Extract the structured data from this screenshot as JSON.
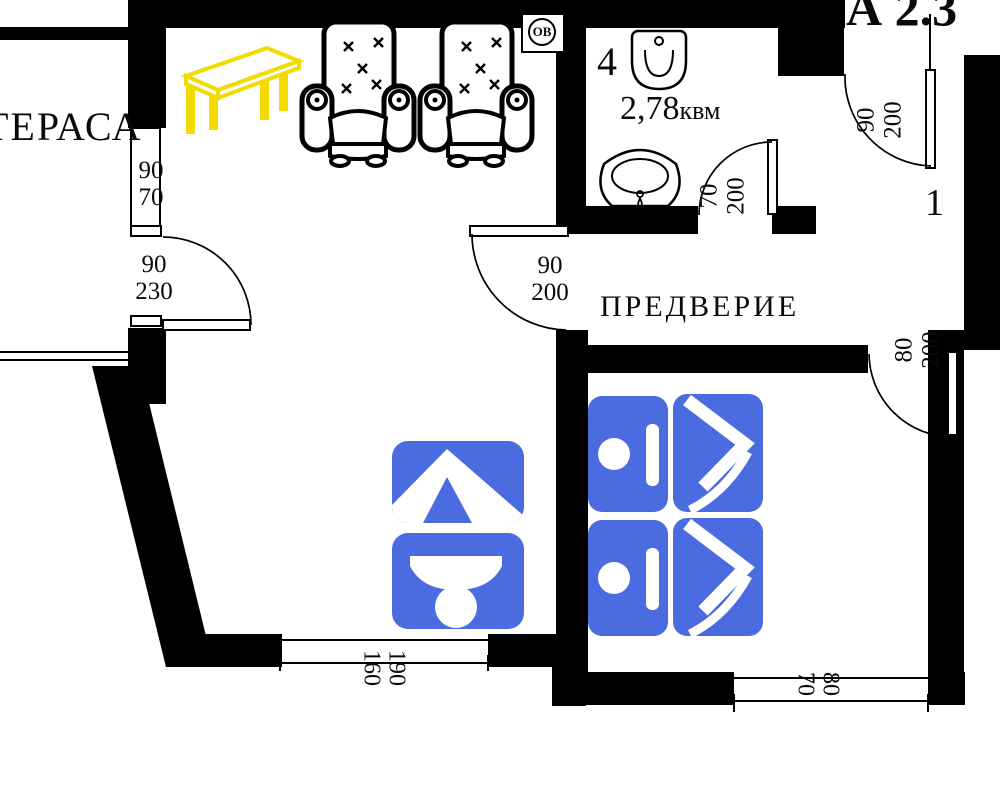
{
  "title": "А 2.3",
  "rooms": {
    "terrace": {
      "label": "ТЕРАСА"
    },
    "vestibule": {
      "label": "ПРЕДВЕРИЕ"
    },
    "bathroom": {
      "number": "4",
      "area_value": "2,78",
      "area_unit": "квм"
    },
    "entry": {
      "number": "1"
    }
  },
  "symbols": {
    "shaft_label": "ОВ"
  },
  "dimensions": {
    "terrace_window": {
      "width": "90",
      "height": "70"
    },
    "terrace_door": {
      "width": "90",
      "height": "230"
    },
    "living_vestibule_door": {
      "width": "90",
      "height": "200"
    },
    "bathroom_door": {
      "width": "70",
      "height": "200"
    },
    "entry_door": {
      "width": "90",
      "height": "200"
    },
    "bedroom_door": {
      "width": "80",
      "height": "200"
    },
    "living_window": {
      "width": "190",
      "height": "160"
    },
    "bedroom_window": {
      "width": "80",
      "height": "70"
    }
  },
  "colors": {
    "wall": "#000000",
    "furniture_icon_blue": "#4b6ce1",
    "table_yellow": "#f2dc00"
  }
}
